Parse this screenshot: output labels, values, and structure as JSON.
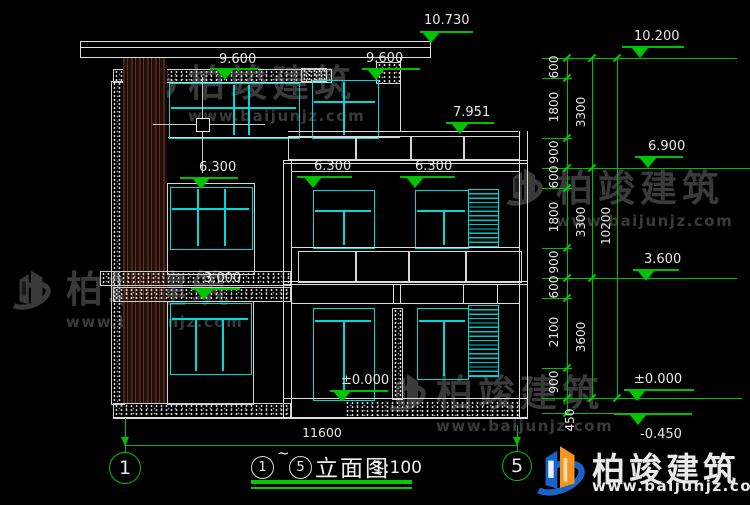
{
  "watermark": {
    "brand": "柏竣建筑",
    "url": "www.baijunjz.com"
  },
  "logo": {
    "brand": "柏竣建筑",
    "url": "www.baijunjz.com"
  },
  "markers": {
    "roof": "10.730",
    "third_left": "9.600",
    "third_right": "9.600",
    "terrace": "7.951",
    "second_left": "6.300",
    "second_mid": "6.300",
    "second_right": "6.300",
    "first": "3.000",
    "ground": "±0.000",
    "right_top": "10.200",
    "right_69": "6.900",
    "right_36": "3.600",
    "right_zero": "±0.000",
    "right_neg": "-0.450"
  },
  "dims": {
    "inner": [
      "600",
      "1800",
      "900",
      "600",
      "1800",
      "900",
      "600",
      "2100",
      "900",
      "450"
    ],
    "mid": [
      "3300",
      "3300",
      "3600"
    ],
    "total": "10200",
    "width": "11600"
  },
  "axes": {
    "left": "1",
    "right": "5"
  },
  "title": {
    "start": "1",
    "sep": "~",
    "end": "5",
    "name": "立面图",
    "scale": "1:100"
  },
  "colors": {
    "line": "#e0e0e0",
    "cyan": "#00d9d9",
    "green": "#00bf00",
    "wood": "#4a241a",
    "brand_blue": "#1a63c8",
    "brand_orange": "#f6941d"
  }
}
